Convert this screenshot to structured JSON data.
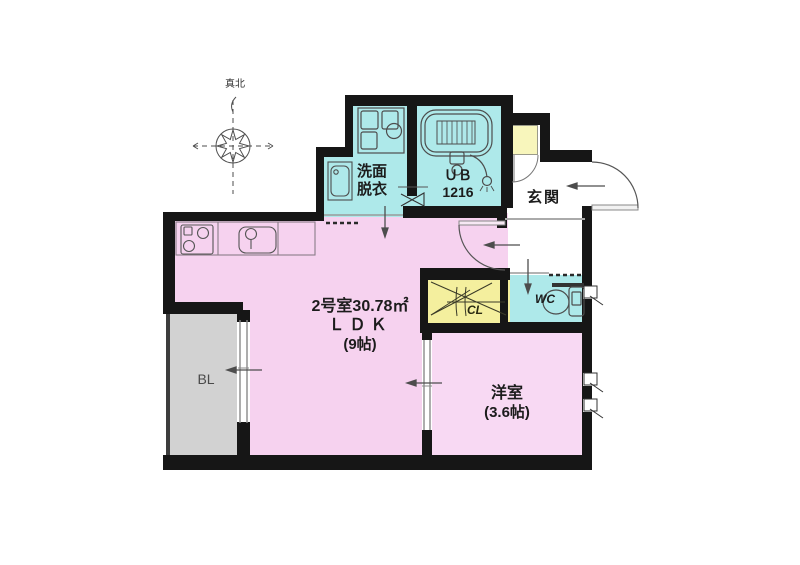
{
  "compass": {
    "label": "真北"
  },
  "rooms": {
    "ldk": {
      "area_line": "2号室30.78㎡",
      "name": "ＬＤＫ",
      "size": "(9帖)",
      "color": "#f6d2ef"
    },
    "washroom": {
      "name_line1": "洗面",
      "name_line2": "脱衣",
      "color": "#aee9ea"
    },
    "bath": {
      "name": "ＵＢ",
      "size": "1216",
      "color": "#aee9ea"
    },
    "entrance": {
      "name": "玄関",
      "color": "#ffffff"
    },
    "wc": {
      "name": "WC",
      "color": "#aee9ea"
    },
    "closet": {
      "name": "CL",
      "color": "#f4ef9e"
    },
    "balcony": {
      "name": "BL",
      "color": "#d2d2d2"
    },
    "western": {
      "name": "洋室",
      "size": "(3.6帖)",
      "color": "#f8d9f3"
    }
  },
  "colors": {
    "wall": "#161616",
    "fixture_line": "#4d4d4d",
    "shoe_box": "#f8f6bc"
  }
}
